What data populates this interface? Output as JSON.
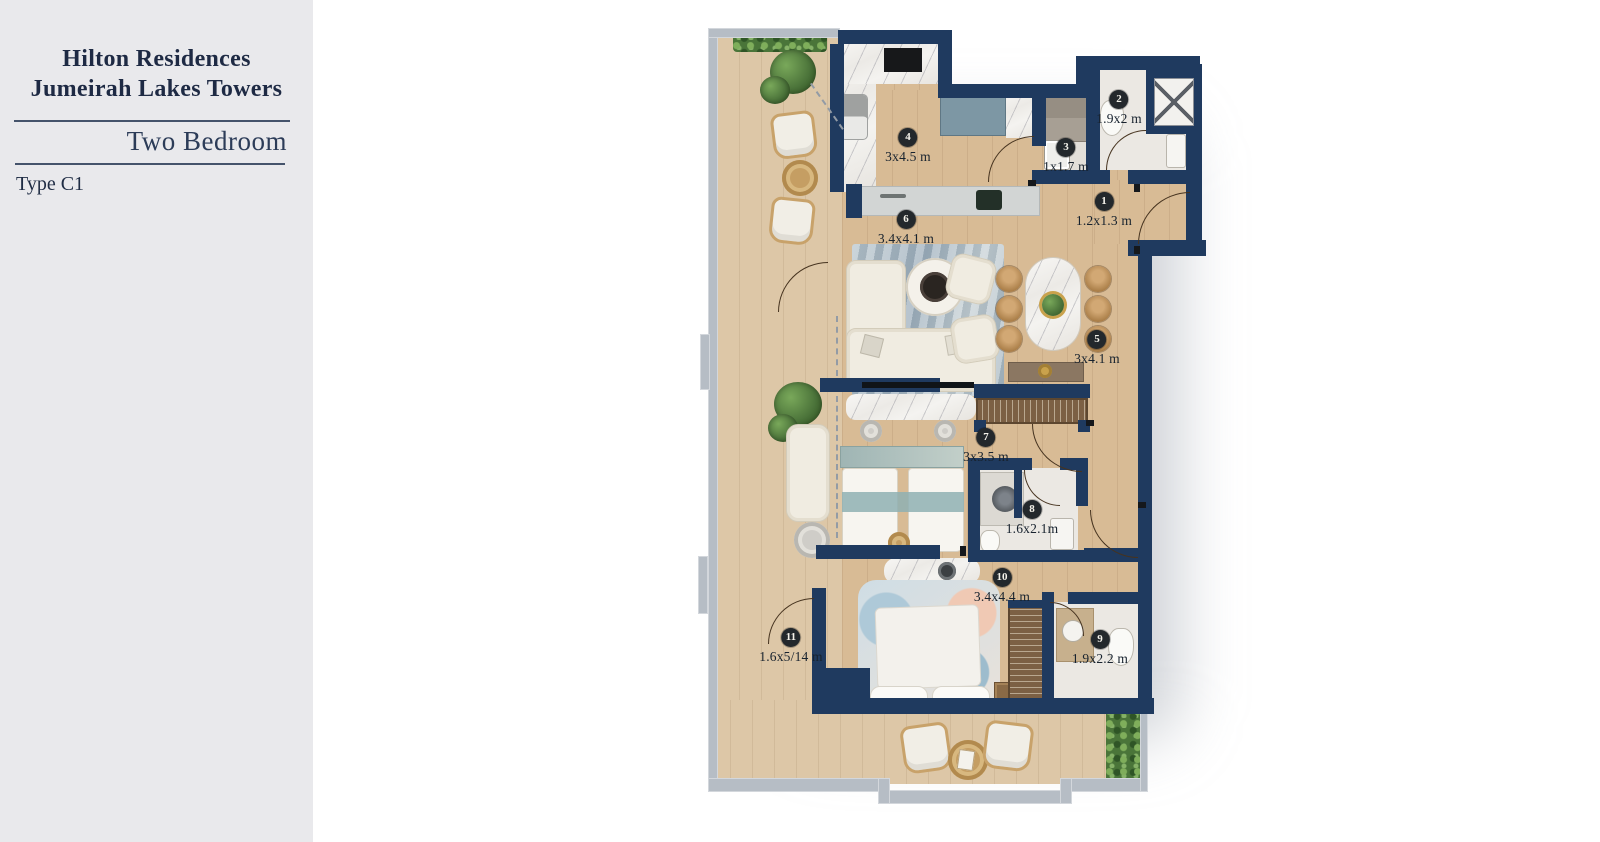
{
  "panel": {
    "title_line1": "Hilton Residences",
    "title_line2": "Jumeirah Lakes Towers",
    "subtitle": "Two Bedroom",
    "type_label": "Type C1"
  },
  "plan": {
    "rooms": [
      {
        "num": "1",
        "dim": "1.2x1.3 m"
      },
      {
        "num": "2",
        "dim": "1.9x2 m"
      },
      {
        "num": "3",
        "dim": "1x1.7 m"
      },
      {
        "num": "4",
        "dim": "3x4.5 m"
      },
      {
        "num": "5",
        "dim": "3x4.1 m"
      },
      {
        "num": "6",
        "dim": "3.4x4.1 m"
      },
      {
        "num": "7",
        "dim": "3x3.5 m"
      },
      {
        "num": "8",
        "dim": "1.6x2.1m"
      },
      {
        "num": "9",
        "dim": "1.9x2.2 m"
      },
      {
        "num": "10",
        "dim": "3.4x4.4 m"
      },
      {
        "num": "11",
        "dim": "1.6x5/14 m"
      }
    ],
    "colors": {
      "wall": "#1f3a5f",
      "wood_floor": "#d8bb95",
      "balcony_floor": "#ddc7a7",
      "bath_floor": "#ebe8e3",
      "outer_wall": "#b6bdc5",
      "greenery": "#4a7539",
      "badge": "#23282c",
      "label_text": "#17222e",
      "panel_bg": "#e9e9ec",
      "title_text": "#1e2a44"
    }
  }
}
